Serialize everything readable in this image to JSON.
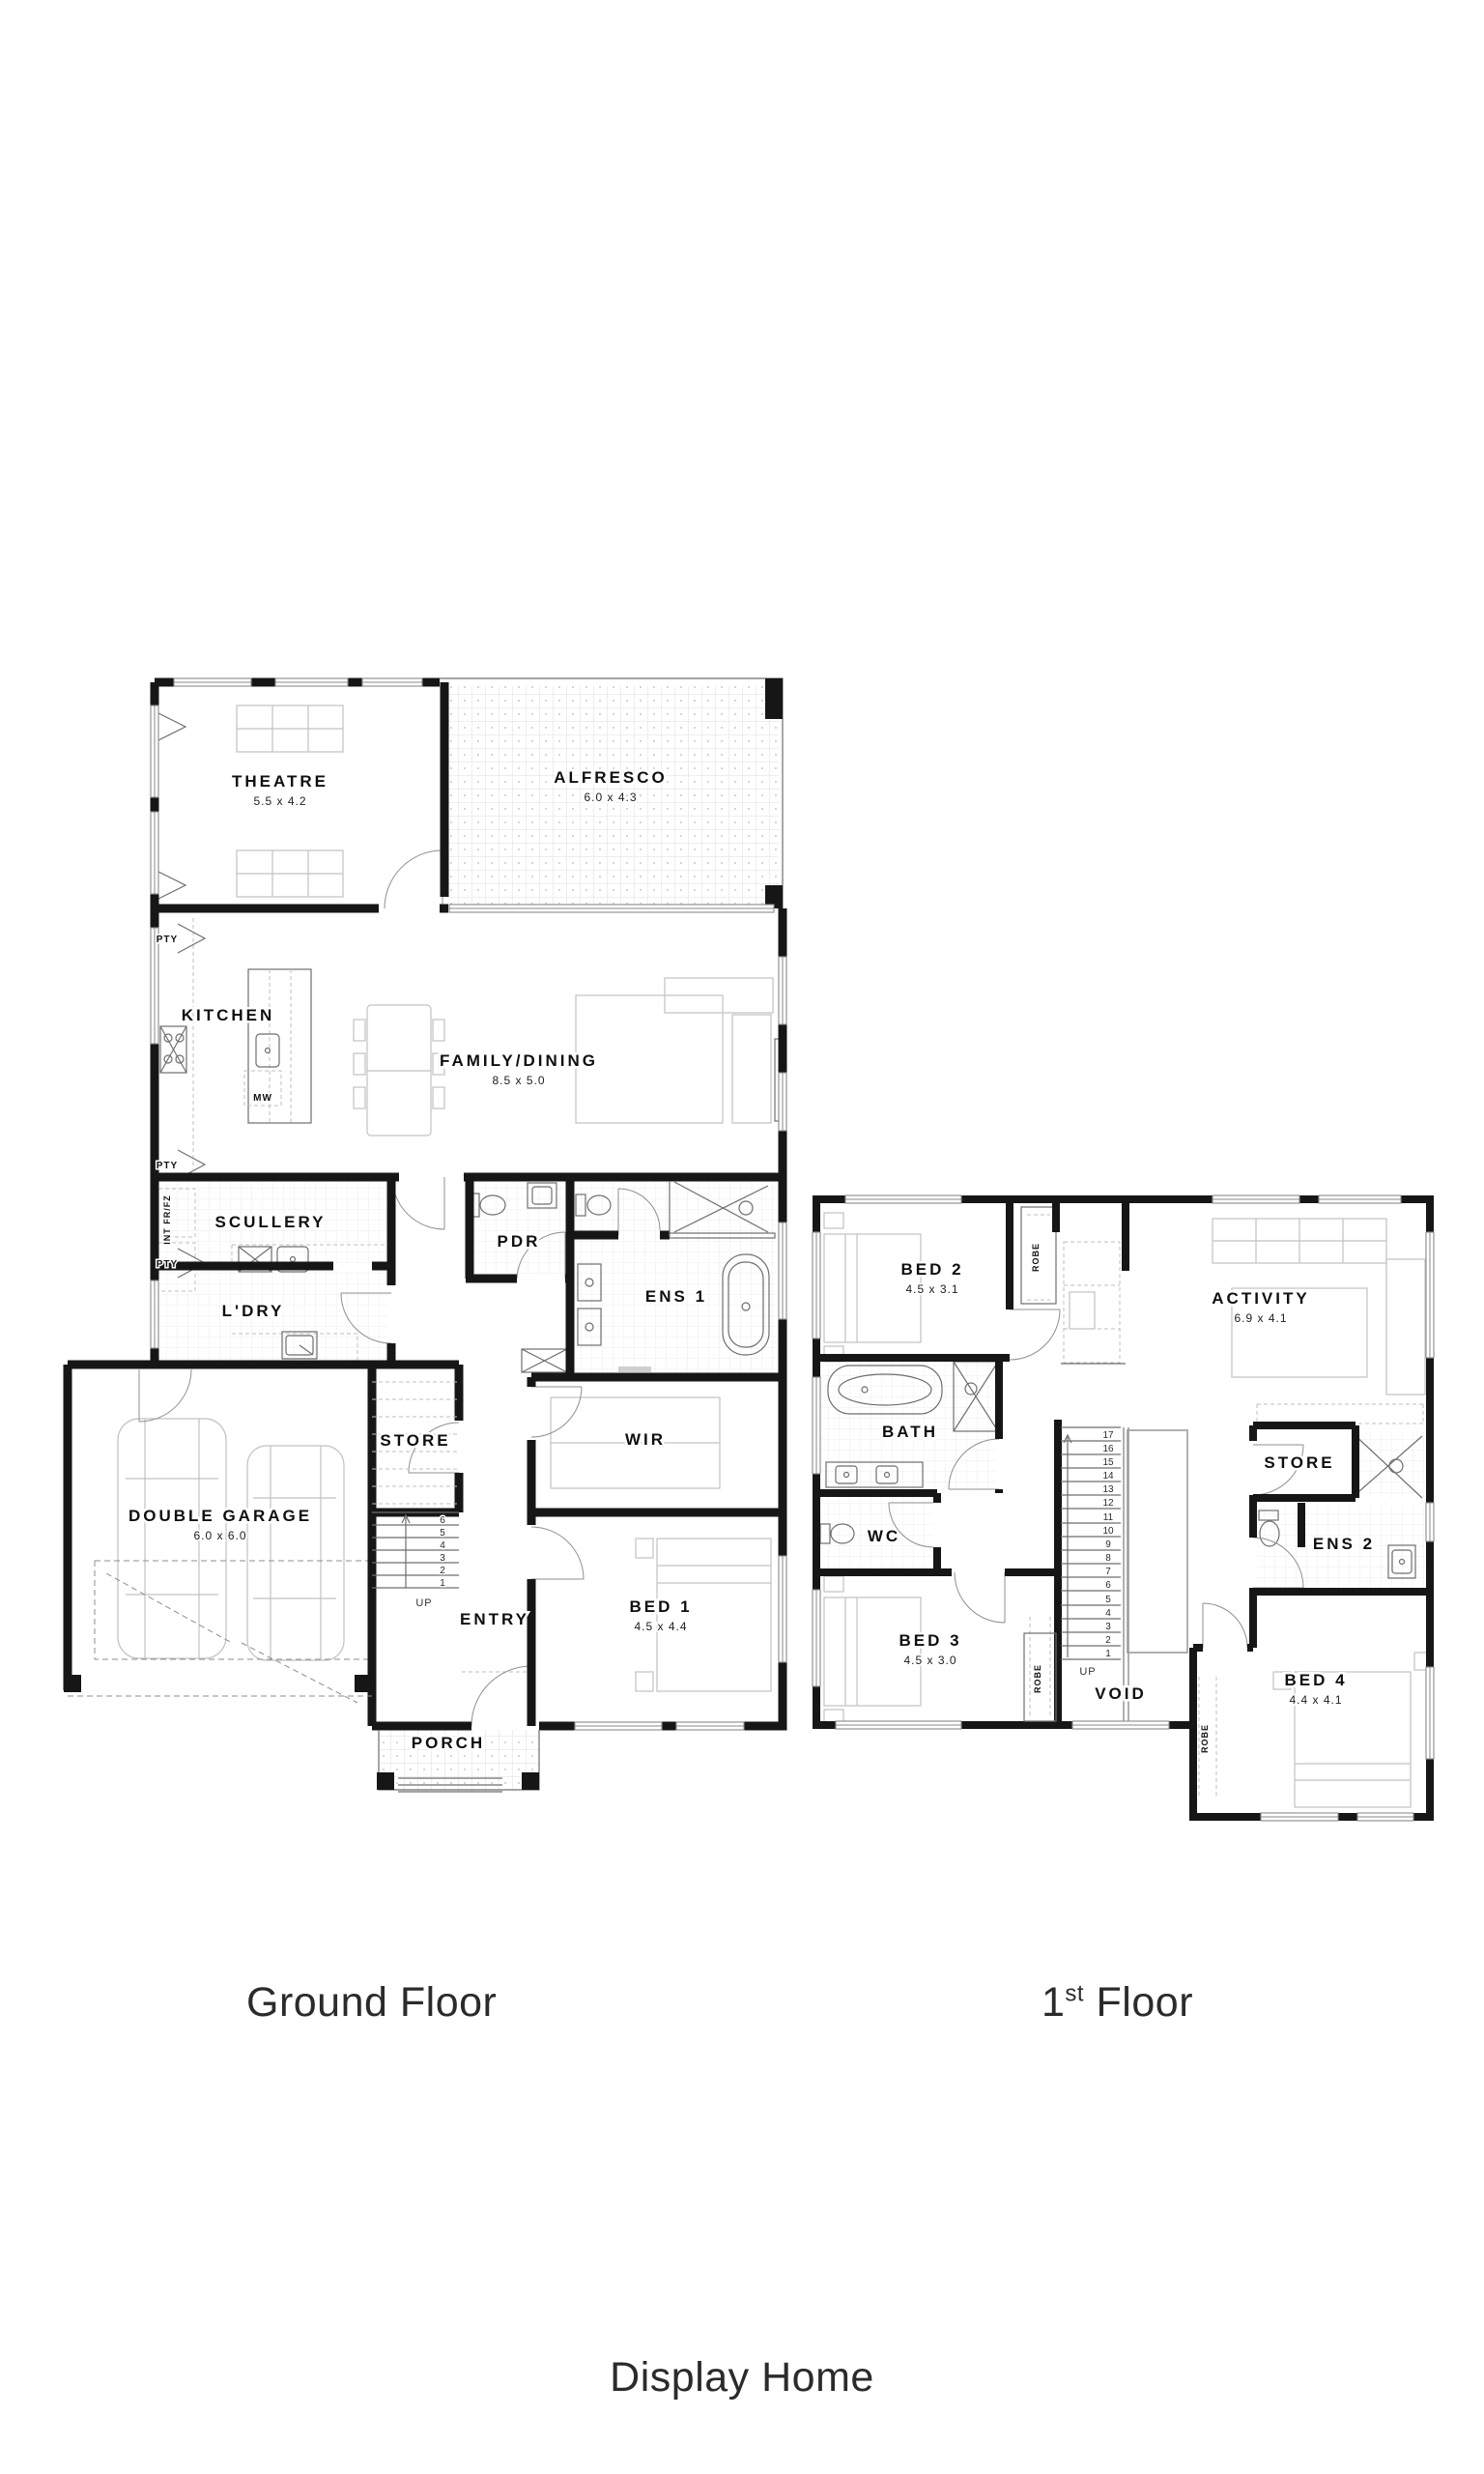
{
  "captions": {
    "ground": "Ground Floor",
    "first_num": "1",
    "first_sup": "st",
    "first_rest": " Floor",
    "footer": "Display Home"
  },
  "ground": {
    "theatre_name": "THEATRE",
    "theatre_dim": "5.5 x 4.2",
    "alfresco_name": "ALFRESCO",
    "alfresco_dim": "6.0 x 4.3",
    "kitchen_name": "KITCHEN",
    "family_name": "FAMILY/DINING",
    "family_dim": "8.5 x 5.0",
    "scullery_name": "SCULLERY",
    "pdr_name": "PDR",
    "ens1_name": "ENS 1",
    "ldry_name": "L'DRY",
    "store_name": "STORE",
    "wir_name": "WIR",
    "garage_name": "DOUBLE GARAGE",
    "garage_dim": "6.0 x 6.0",
    "entry_name": "ENTRY",
    "bed1_name": "BED 1",
    "bed1_dim": "4.5 x 4.4",
    "porch_name": "PORCH",
    "pty1": "PTY",
    "pty2": "PTY",
    "pty3": "PTY",
    "int_frfz": "INT FR/FZ",
    "mw": "MW",
    "up": "UP",
    "stairs": [
      "6",
      "5",
      "4",
      "3",
      "2",
      "1"
    ]
  },
  "first": {
    "bed2_name": "BED 2",
    "bed2_dim": "4.5 x 3.1",
    "activity_name": "ACTIVITY",
    "activity_dim": "6.9 x 4.1",
    "bath_name": "BATH",
    "wc_name": "WC",
    "store_name": "STORE",
    "ens2_name": "ENS 2",
    "bed3_name": "BED 3",
    "bed3_dim": "4.5 x 3.0",
    "void_name": "VOID",
    "bed4_name": "BED 4",
    "bed4_dim": "4.4 x 4.1",
    "robe1": "ROBE",
    "robe2": "ROBE",
    "robe3": "ROBE",
    "up": "UP",
    "stairs": [
      "17",
      "16",
      "15",
      "14",
      "13",
      "12",
      "11",
      "10",
      "9",
      "8",
      "7",
      "6",
      "5",
      "4",
      "3",
      "2",
      "1"
    ]
  }
}
